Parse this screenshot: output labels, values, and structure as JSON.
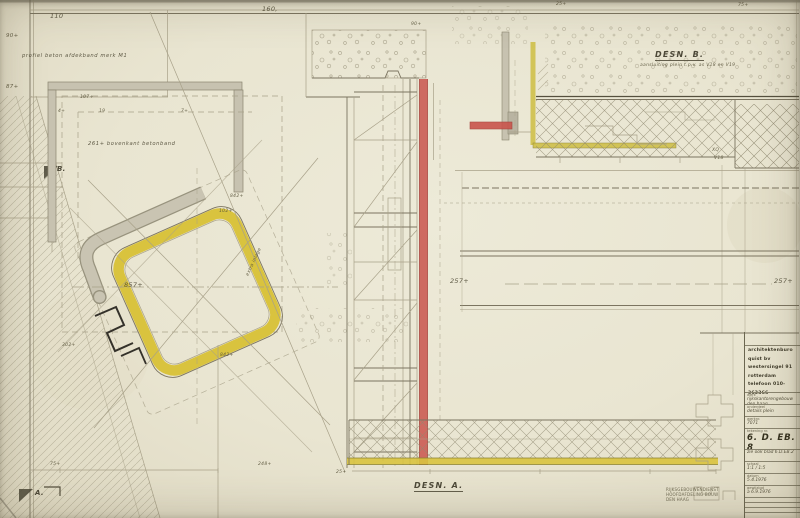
{
  "sheet": {
    "labels": {
      "d110": "110",
      "d160": "160,",
      "d90a": "90+",
      "d87": "87+",
      "d107": "107+",
      "d4": "4+",
      "d19": "19",
      "d7": "7+",
      "d90b": "90+",
      "d857": "857+",
      "d257l": "257+",
      "d257r": "257+",
      "d842a": "842+",
      "d102": "102+",
      "d842b": "842+",
      "d302": "302+",
      "d75": "75+",
      "d248": "248+",
      "d25": "25+",
      "d25b": "25+",
      "d75b": "75+",
      "xq": "XQ",
      "v18": "V18",
      "marker_a": "A.",
      "marker_b": "B."
    },
    "notes": {
      "profiel": "profiel beton afdekband merk M1",
      "bovenkant": "261+ bovenkant betonband",
      "extra": "extra inlage"
    },
    "details": {
      "desn_a": "DESN. A.",
      "desn_b": "DESN. B.",
      "desn_b_sub": "aansluiting plein t.p.v. as V18 en V19"
    },
    "stamp": {
      "line1": "RIJKSGEBOUWENDIENST",
      "line2": "HOOFDAFDELING BOUW",
      "line3": "DEN HAAG"
    },
    "title_block": {
      "architect": {
        "l1": "architektenburo",
        "l2": "quist bv",
        "l3": "westersingel 91",
        "l4": "rotterdam",
        "l5": "telefoon 010-363366"
      },
      "fields": [
        {
          "label": "werk",
          "value": "rijkskantorengebouw den haag"
        },
        {
          "label": "onderdeel",
          "value": "details plein"
        },
        {
          "label": "werknr.",
          "value": "7071"
        }
      ],
      "drawing_no_label": "tekening nr.",
      "drawing_no": "6. D. EB. 8",
      "note": "zie ook blad 6.D.EB.2",
      "small_fields": [
        {
          "label": "schaal",
          "value": "1:1 / 1:5"
        },
        {
          "label": "datum",
          "value": "5.4.1976"
        },
        {
          "label": "gewijzigd",
          "value": "a  6.9.1976"
        }
      ],
      "format_label": "formaat",
      "format_value": ""
    },
    "colors": {
      "paper": "#eae6d2",
      "red": "#c9544c",
      "yellow": "#d9c33e",
      "grey": "#c7c2b0",
      "ink": "#55503e"
    }
  }
}
